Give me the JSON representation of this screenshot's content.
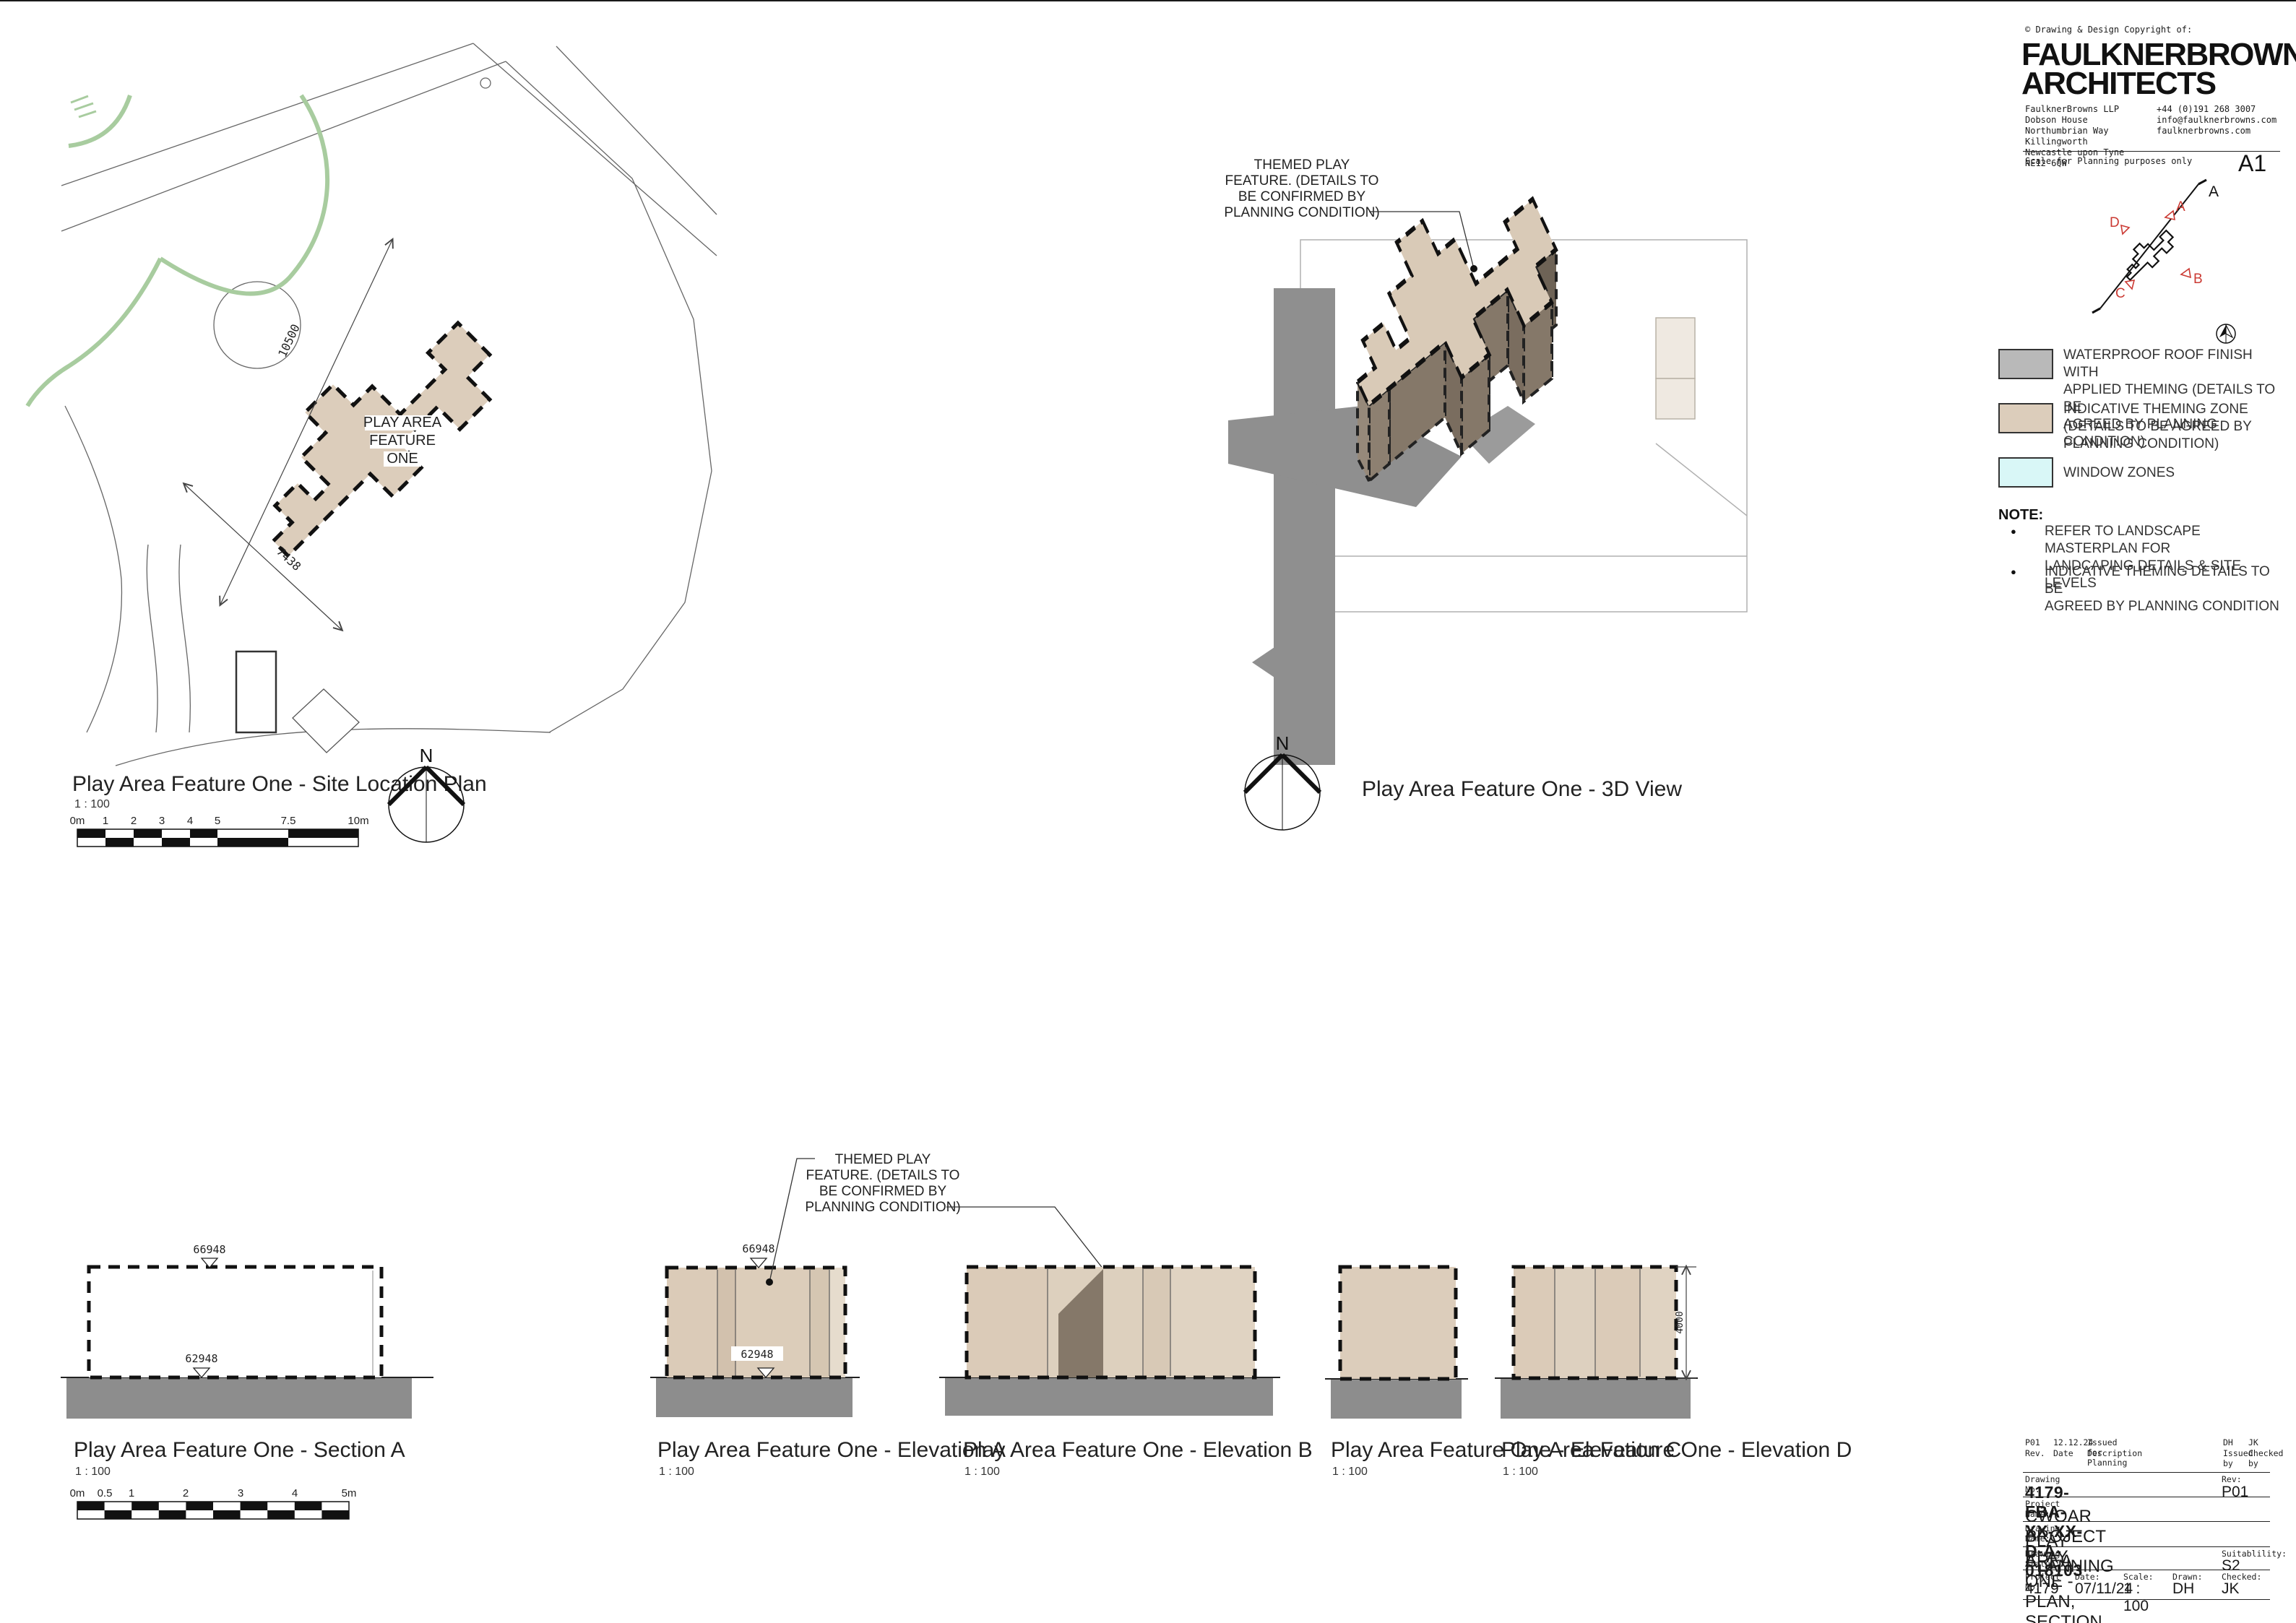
{
  "sheet": {
    "size_label": "A1"
  },
  "header": {
    "copyright": "© Drawing & Design Copyright of:",
    "logo": "FAULKNERBROWNS\nARCHITECTS",
    "address": "FaulknerBrowns LLP\nDobson House\nNorthumbrian Way\nKillingworth\nNewcastle upon Tyne\nNE12 6QW",
    "contact": "+44 (0)191 268 3007\ninfo@faulknerbrowns.com\nfaulknerbrowns.com",
    "scale_note": "Scale for Planning purposes only"
  },
  "key_plan": {
    "section_label": "A",
    "elev_a": "A",
    "elev_b": "B",
    "elev_c": "C",
    "elev_d": "D"
  },
  "legend": {
    "items": [
      {
        "label": "WATERPROOF ROOF FINISH WITH\nAPPLIED THEMING (DETAILS TO BE\nAGREED BY PLANNING CONDITION)",
        "color": "#b9b9b9"
      },
      {
        "label": "INDICATIVE THEMING ZONE\n(DETAILS TO BE AGREED BY\nPLANNING CONDITION)",
        "color": "#dccdbb"
      },
      {
        "label": "WINDOW ZONES",
        "color": "#d9f7f7"
      }
    ]
  },
  "notes": {
    "title": "NOTE:",
    "items": [
      "REFER TO LANDSCAPE MASTERPLAN FOR\nLANDCAPING DETAILS & SITE LEVELS",
      "INDICATIVE THEMING DETAILS TO BE\nAGREED BY PLANNING CONDITION"
    ]
  },
  "drawings": {
    "site_plan": {
      "title": "Play Area Feature One - Site Location Plan",
      "scale": "1 : 100"
    },
    "view3d": {
      "title": "Play Area Feature One - 3D View"
    },
    "section_a": {
      "title": "Play Area Feature One - Section A",
      "scale": "1 : 100"
    },
    "elevation_a": {
      "title": "Play Area Feature One - Elevation A",
      "scale": "1 : 100"
    },
    "elevation_b": {
      "title": "Play Area Feature One - Elevation B",
      "scale": "1 : 100"
    },
    "elevation_c": {
      "title": "Play Area Feature One - Elevation C",
      "scale": "1 : 100"
    },
    "elevation_d": {
      "title": "Play Area Feature One - Elevation D",
      "scale": "1 : 100"
    }
  },
  "plan": {
    "label_l1": "PLAY AREA",
    "label_l2": "FEATURE",
    "label_l3": "ONE",
    "dim1": "10500",
    "dim2": "7438"
  },
  "annotation": {
    "l1": "THEMED PLAY",
    "l2": "FEATURE. (DETAILS TO",
    "l3": "BE CONFIRMED BY",
    "l4": "PLANNING CONDITION)"
  },
  "levels": {
    "top": "66948",
    "ground": "62948",
    "height": "4000"
  },
  "north": {
    "label": "N"
  },
  "scalebars": {
    "site": {
      "ticks": [
        "0m",
        "1",
        "2",
        "3",
        "4",
        "5",
        "7.5",
        "10m"
      ]
    },
    "section": {
      "ticks": [
        "0m",
        "0.5",
        "1",
        "2",
        "3",
        "4",
        "5m"
      ]
    }
  },
  "title_block": {
    "rev_row": {
      "rev": "P01",
      "date": "12.12.24",
      "description": "Issued for Planning",
      "issued": "DH",
      "checked": "JK"
    },
    "rev_head": {
      "rev": "Rev.",
      "date": "Date",
      "description": "Description",
      "issued": "Issued\nby",
      "checked": "Checked\nby"
    },
    "drawing_no_label": "Drawing No:",
    "drawing_no": "4179-FBA-XX-XX-D-A-018103",
    "rev_label": "Rev:",
    "rev": "P01",
    "project_name_label": "Project Name:",
    "project_name": "CWOAR PROJECT PLAY",
    "drawing_name_label": "Drawing Name:",
    "drawing_name": "PLAY AREA ONE - PLAN, SECTION, ELE'S",
    "status_label": "Drawing Status:",
    "status": "PLANNING",
    "suitability_label": "Suitablility:",
    "suitability": "S2",
    "project_no_label": "Project No:",
    "project_no": "4179",
    "date_label": "Date:",
    "date": "07/11/24",
    "scale_label": "Scale:",
    "scale": "1 : 100",
    "drawn_label": "Drawn:",
    "drawn": "DH",
    "checked_label": "Checked:",
    "checked": "JK"
  },
  "colors": {
    "theming_tan": "#dccdbb",
    "roof_gray": "#b9b9b9",
    "window_cyan": "#d9f7f7",
    "ground_gray": "#8d8d8d",
    "marker_red": "#cb3a33",
    "landscape_green": "#a8cc9f"
  }
}
